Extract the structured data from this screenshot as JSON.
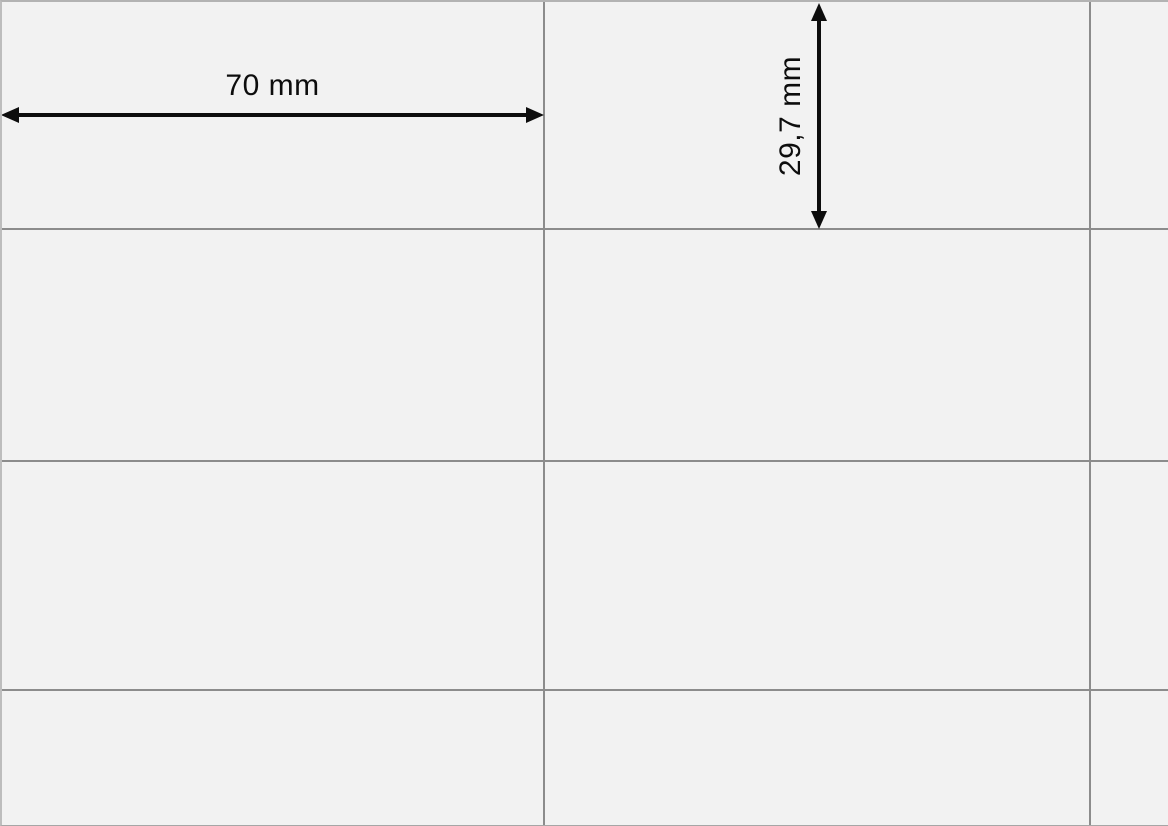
{
  "sheet": {
    "type": "label-sheet-template",
    "dimensions": {
      "width_label": "70 mm",
      "height_label": "29,7 mm"
    },
    "grid": {
      "columns_visible": 3,
      "rows_visible": 4,
      "cell_width_mm": 70,
      "cell_height_mm": 29.7
    },
    "colors": {
      "cell_background": "#f2f2f2",
      "grid_line": "#8c8c8c",
      "top_edge_line": "#b3b3b3",
      "left_edge_line": "#bdbdbd",
      "bottom_edge_line": "#a6a6a6",
      "arrow": "#0d0d0d",
      "label_text": "#0d0d0d"
    }
  }
}
